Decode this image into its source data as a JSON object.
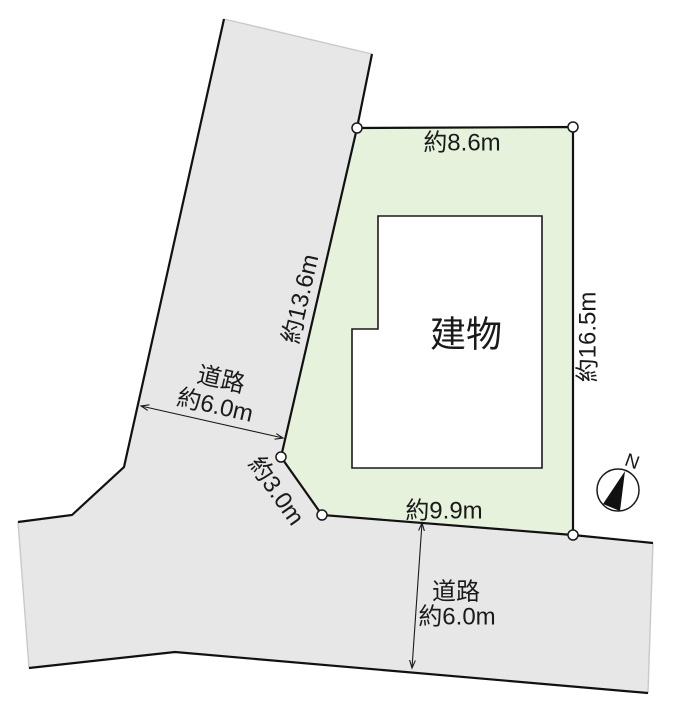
{
  "plot": {
    "dimensions": {
      "top": "約8.6m",
      "right": "約16.5m",
      "diagonal": "約13.6m",
      "bottom": "約9.9m",
      "corner_cut": "約3.0m"
    }
  },
  "building": {
    "label": "建物"
  },
  "roads": {
    "northwest": {
      "name": "道路",
      "width": "約6.0m"
    },
    "south": {
      "name": "道路",
      "width": "約6.0m"
    }
  },
  "compass": {
    "north_label": "N"
  },
  "colors": {
    "plot_fill": "#e6f2dc",
    "road_fill": "#e7e7e7",
    "outline": "#111111",
    "background": "#ffffff"
  }
}
